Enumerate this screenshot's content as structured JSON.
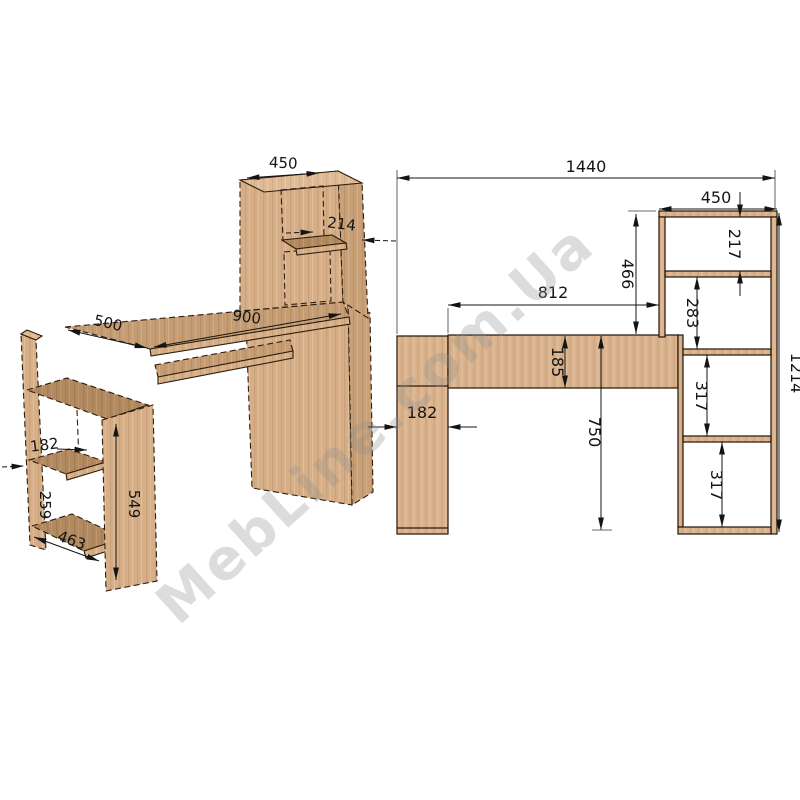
{
  "watermark": {
    "text": "MebLine.com.Ua"
  },
  "colors": {
    "background": "#ffffff",
    "wood_light": "#debb96",
    "wood_front": "#d6af89",
    "wood_top": "#c59d74",
    "wood_dark": "#b28a61",
    "outline": "#2e1d0e",
    "dimension_lines": "#141414",
    "watermark_gray": "#8f8f8f"
  },
  "isometric_view": {
    "description": "isometric projection of computer desk with hutch and side shelving",
    "dims": {
      "hutch_width": "450",
      "hutch_shelf_depth": "214",
      "desk_depth": "500",
      "desk_length": "900",
      "side_niche_depth": "182",
      "side_niche_height": "259",
      "side_unit_height": "549",
      "side_unit_length": "463"
    }
  },
  "front_view": {
    "description": "front elevation with overall dimensions",
    "dims": {
      "overall_width": "1440",
      "hutch_width": "450",
      "hutch_top_niche": "217",
      "hutch_height": "466",
      "desk_inner_span": "812",
      "hutch_middle_niche": "283",
      "apron_height": "185",
      "side_panel_depth": "182",
      "desk_height": "750",
      "lower_niche_a": "317",
      "lower_niche_b": "317",
      "overall_height": "1214"
    }
  }
}
